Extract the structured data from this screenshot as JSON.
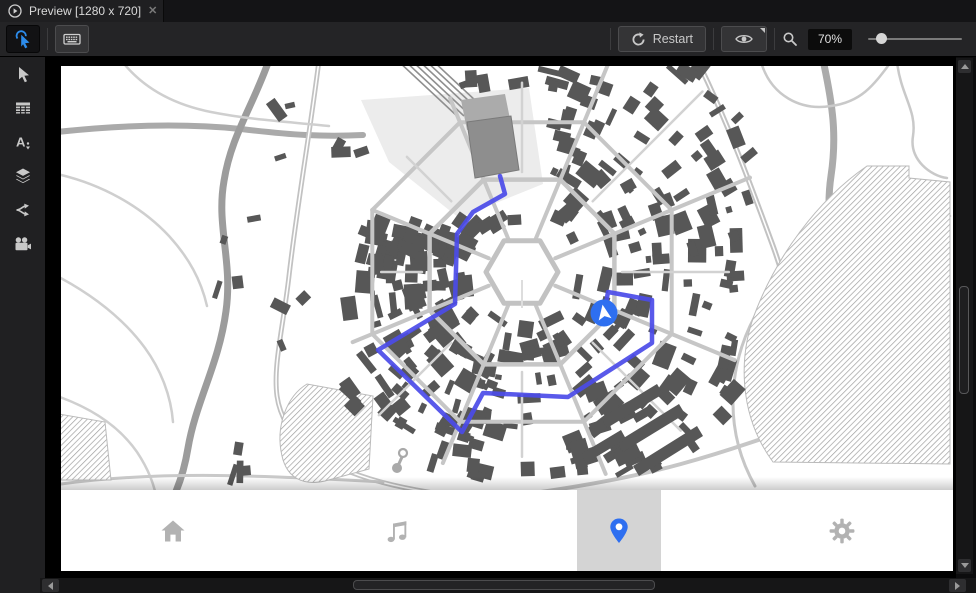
{
  "window": {
    "tab": {
      "title": "Preview [1280 x 720]"
    },
    "toolbar": {
      "restart_label": "Restart",
      "zoom_value": "70%",
      "zoom_slider_fraction": 0.08,
      "tools": [
        {
          "name": "tap-tool",
          "icon": "tap-cursor-icon",
          "selected": true
        },
        {
          "name": "keyboard-tool",
          "icon": "keyboard-icon",
          "selected": false
        }
      ]
    },
    "left_toolbar_icons": [
      "select-arrow-icon",
      "table-icon",
      "text-style-icon",
      "layers-icon",
      "connections-icon",
      "camera-icon"
    ]
  },
  "preview": {
    "navbar": {
      "items": [
        {
          "name": "home",
          "icon": "home-icon",
          "selected": false
        },
        {
          "name": "music",
          "icon": "music-note-icon",
          "selected": false
        },
        {
          "name": "location",
          "icon": "location-pin-icon",
          "selected": true
        },
        {
          "name": "settings",
          "icon": "gear-icon",
          "selected": false
        }
      ],
      "selected_tile_color": "#d4d4d4",
      "icon_color": "#b2b2b2",
      "pin_color": "#2e6ff0"
    },
    "map": {
      "colors": {
        "bg": "#ffffff",
        "building": "#575757",
        "road": "#c6c6c6",
        "road_minor": "#d2d2d2",
        "road_major": "#aaaaaa",
        "river": "#9c9c9c",
        "hatch": "#9f9f9f",
        "plaza": "#ececec",
        "rail": "#8f8f8f",
        "station_front": "#8e8e8e",
        "station_top": "#ababab",
        "route": "#4b4be8",
        "marker": "#2e6ff0",
        "poi": "#a9a9a9"
      },
      "center": {
        "x": 461,
        "y": 206
      },
      "rings": [
        36,
        100,
        162
      ],
      "spoke_count": 8,
      "rmax_by_dir": [
        235,
        255,
        210,
        230,
        160,
        185,
        215,
        290
      ],
      "seed": 3,
      "building_count": 430,
      "scatter_boxes": [
        {
          "x0": 140,
          "x1": 245,
          "y0": 150,
          "y1": 280,
          "n": 7
        },
        {
          "x0": 205,
          "x1": 315,
          "y0": 28,
          "y1": 95,
          "n": 6
        },
        {
          "x0": 62,
          "x1": 185,
          "y0": 372,
          "y1": 418,
          "n": 4
        }
      ],
      "route": [
        [
          439,
          110
        ],
        [
          444,
          128
        ],
        [
          412,
          146
        ],
        [
          396,
          168
        ],
        [
          394,
          238
        ],
        [
          317,
          284
        ],
        [
          401,
          366
        ],
        [
          422,
          327
        ],
        [
          507,
          331
        ],
        [
          591,
          277
        ],
        [
          591,
          234
        ],
        [
          547,
          226
        ],
        [
          544,
          243
        ]
      ],
      "marker": {
        "x": 543,
        "y": 247
      },
      "poi": {
        "head_x": 342,
        "head_y": 387,
        "base_x": 336,
        "base_y": 402
      },
      "rail": {
        "n": 6,
        "x0": 336,
        "dx": 7,
        "y0": -6,
        "x1": 396,
        "y1": 50
      },
      "station": {
        "front": "M406,56 L450,50 L458,104 L414,112 Z",
        "top": "M400,34 L444,28 L450,58 L406,64 Z"
      },
      "plaza": "M300,34 L468,22 L482,118 L398,152 L328,96 Z",
      "parks": [
        "M806,100 L848,100 L848,112 L889,116 L889,398 L712,396 C678,350 676,290 696,242 C716,192 754,136 806,100 Z",
        "M246,318 C226,330 214,360 221,390 C226,412 242,420 264,415 L308,403 L312,330 Z",
        "M-2,348 L44,356 L50,414 L-2,414 Z"
      ],
      "roads": [
        {
          "d": "M-4,66 C60,59 120,57 180,63 C230,69 262,71 302,69",
          "w": 6,
          "c": "#aaaaaa"
        },
        {
          "d": "M208,-6 C192,40 170,70 163,115 C155,160 172,195 165,245 C158,298 135,335 127,382 C120,425 105,445 92,470",
          "w": 7,
          "c": "#9c9c9c"
        },
        {
          "d": "M258,-6 C250,60 236,140 228,210 C222,262 212,300 216,330 C222,372 260,400 320,416 C380,432 470,440 560,442",
          "w": 5,
          "c": "#c2c2c2",
          "mid": true
        },
        {
          "d": "M762,-6 C772,40 776,70 770,110 C764,150 772,190 782,235 C790,270 788,300 780,330",
          "w": 7,
          "c": "#ababab"
        },
        {
          "d": "M640,2 C668,60 690,120 712,180 C722,208 728,230 734,252",
          "w": 5.5,
          "c": "#c2c2c2",
          "mid": true
        },
        {
          "d": "M700,-4 C710,30 740,45 770,40 C800,36 812,20 830,-4",
          "w": 2.5,
          "c": "#c9c9c9"
        },
        {
          "d": "M836,-4 C840,30 856,44 852,70 C848,94 870,110 886,112",
          "w": 2.5,
          "c": "#c9c9c9"
        },
        {
          "d": "M889,150 C860,160 842,190 848,220 C852,240 840,256 826,258",
          "w": 2.5,
          "c": "#c9c9c9"
        },
        {
          "d": "M-4,108 C40,118 80,140 108,170 C128,192 140,214 146,240",
          "w": 2.5,
          "c": "#cfcfcf"
        },
        {
          "d": "M-4,210 C30,228 62,252 84,282 C100,304 110,330 112,356",
          "w": 2.5,
          "c": "#cfcfcf"
        },
        {
          "d": "M-4,330 C30,342 58,360 76,386 C88,404 94,420 96,436",
          "w": 2.5,
          "c": "#cfcfcf"
        },
        {
          "d": "M60,-6 C80,20 110,38 150,46 C190,54 230,56 268,60",
          "w": 2.5,
          "c": "#cfcfcf"
        },
        {
          "d": "M380,440 C450,430 540,420 620,398 C700,376 760,350 828,328",
          "w": 4,
          "c": "#c6c6c6"
        },
        {
          "d": "M694,420 C660,360 668,290 700,240 C720,205 760,170 806,150",
          "w": 3,
          "c": "#c6c6c6"
        },
        {
          "d": "M0,418 C100,404 210,410 322,416",
          "w": 3,
          "c": "#c9c9c9"
        }
      ],
      "se_strips": [
        "M540,352 L596,318 L602,328 L546,362 Z",
        "M556,376 L618,338 L624,348 L562,386 Z",
        "M572,400 L636,360 L642,370 L578,410 Z",
        "M520,388 L560,364 L565,373 L525,397 Z"
      ]
    }
  }
}
